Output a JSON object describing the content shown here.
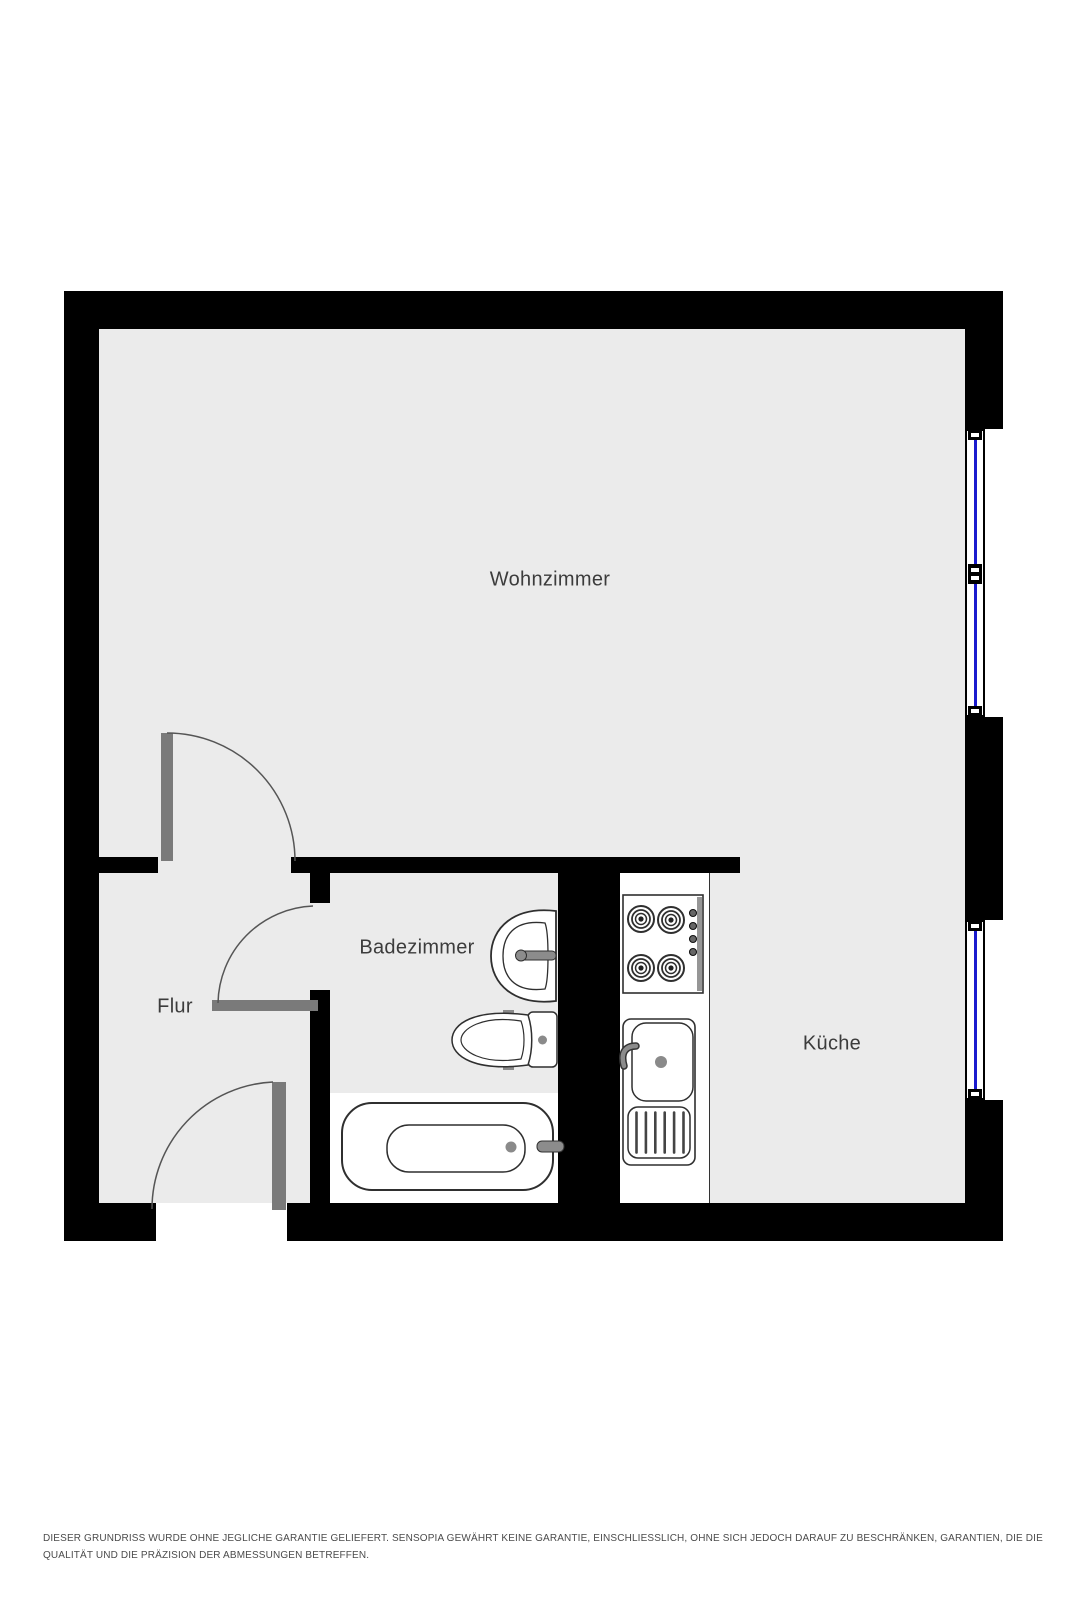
{
  "rooms": {
    "wohnzimmer": {
      "label": "Wohnzimmer"
    },
    "badezimmer": {
      "label": "Badezimmer"
    },
    "flur": {
      "label": "Flur"
    },
    "kueche": {
      "label": "Küche"
    }
  },
  "fixtures": {
    "bathroom": [
      "washbasin",
      "toilet",
      "bathtub"
    ],
    "kitchen": [
      "stove",
      "kitchen-sink"
    ]
  },
  "openings": {
    "windows": 2,
    "doors": 3
  },
  "colors": {
    "wall": "#000000",
    "floor": "#ebebeb",
    "window_glass": "#1b1bce",
    "door_leaf": "#7a7a7a",
    "swing_line": "#555555",
    "fixture_line": "#2f2f2f",
    "label_text": "#3c3c3c",
    "disclaimer_text": "#4b4b4b"
  },
  "disclaimer": {
    "line1": "DIESER GRUNDRISS WURDE OHNE JEGLICHE GARANTIE GELIEFERT. SENSOPIA GEWÄHRT KEINE GARANTIE, EINSCHLIESSLICH, OHNE SICH JEDOCH DARAUF ZU BESCHRÄNKEN, GARANTIEN, DIE DIE",
    "line2": "QUALITÄT UND DIE PRÄZISION DER ABMESSUNGEN BETREFFEN."
  }
}
